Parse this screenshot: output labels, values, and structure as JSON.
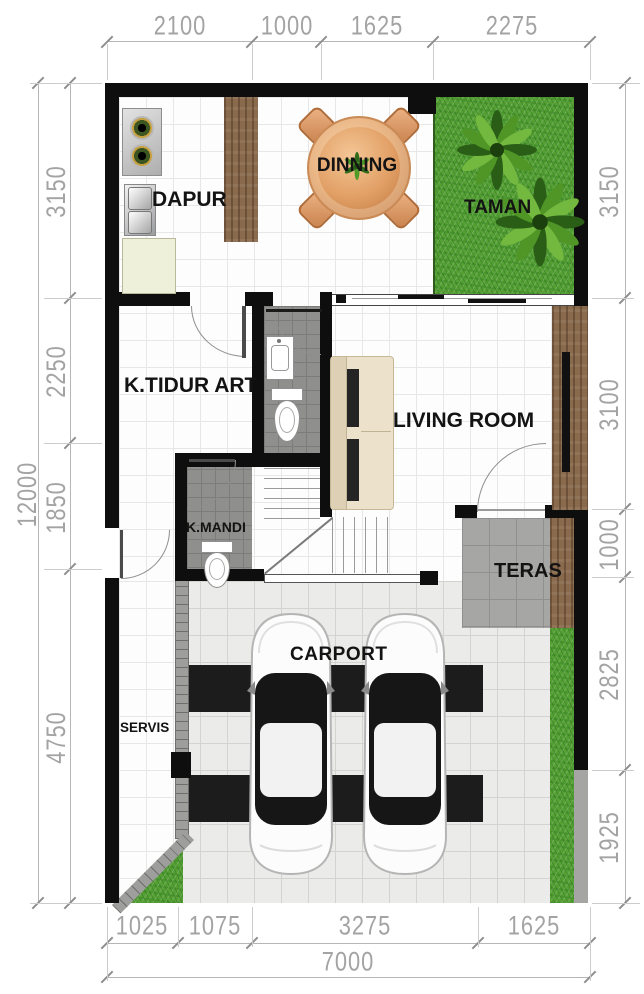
{
  "plan": {
    "title_none": "",
    "rooms": {
      "kitchen": "DAPUR",
      "dining": "DINNING",
      "garden": "TAMAN",
      "maid_bedroom": "K.TIDUR ART",
      "living": "LIVING ROOM",
      "bathroom": "K.MANDI",
      "terrace": "TERAS",
      "service": "SERVIS",
      "carport": "CARPORT"
    },
    "dims": {
      "top": [
        "2100",
        "1000",
        "1625",
        "2275"
      ],
      "left": [
        "3150",
        "2250",
        "1850",
        "4750"
      ],
      "left_total": "12000",
      "right": [
        "3150",
        "3100",
        "1000",
        "2825",
        "1925"
      ],
      "bottom": [
        "1025",
        "1075",
        "3275",
        "1625"
      ],
      "bottom_total": "7000"
    },
    "colors": {
      "wall": "#0e0e0e",
      "grass": "#55a035",
      "wood": "#8a6a4c",
      "gray_tile": "#8f8f8d",
      "carport_stripe": "#1c1c1c",
      "dim_text": "#a3a3a3"
    }
  }
}
